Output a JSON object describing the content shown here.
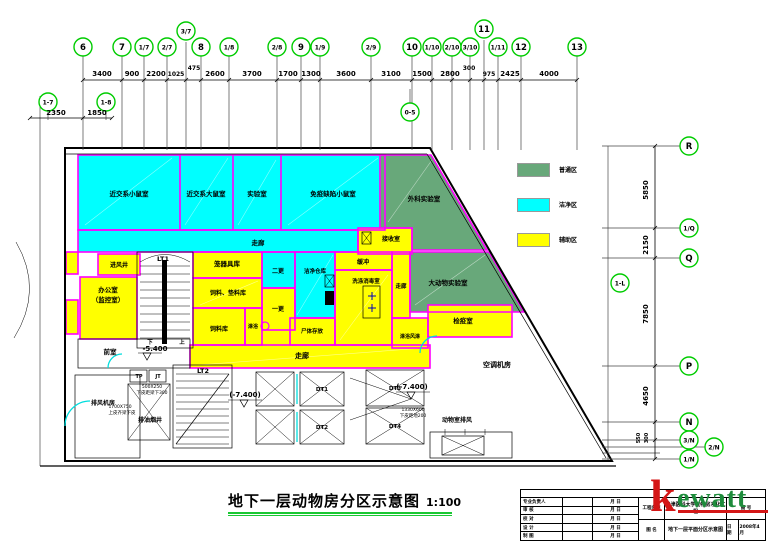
{
  "title": {
    "text": "地下一层动物房分区示意图",
    "scale": "1:100"
  },
  "legend": {
    "items": [
      {
        "label": "普通区",
        "color": "#68A87A"
      },
      {
        "label": "洁净区",
        "color": "#00FFFF"
      },
      {
        "label": "辅助区",
        "color": "#FFFF00"
      }
    ]
  },
  "grid": {
    "top": [
      "6",
      "7",
      "1/7",
      "2/7",
      "3/7",
      "8",
      "1/8",
      "2/8",
      "9",
      "1/9",
      "2/9",
      "10",
      "1/10",
      "2/10",
      "3/10",
      "11",
      "1/11",
      "12",
      "13"
    ],
    "top_dims": [
      "3400",
      "900",
      "2200",
      "1025",
      "475",
      "2600",
      "3700",
      "1700",
      "1300",
      "3600",
      "3100",
      "1500",
      "2800",
      "300",
      "975",
      "2425",
      "4000"
    ],
    "left": [
      "1-7",
      "1-8"
    ],
    "left_dims": [
      "2350",
      "1850"
    ],
    "right": [
      "R",
      "1/Q",
      "Q",
      "P",
      "N",
      "3/N",
      "2/N",
      "1/N"
    ],
    "right_dims": [
      "5850",
      "2150",
      "7850",
      "4650",
      "550",
      "300"
    ],
    "extra": [
      "0-5",
      "1-L"
    ]
  },
  "rooms": {
    "mouse_inbred": "近交系小鼠室",
    "rat_inbred": "近交系大鼠室",
    "lab": "实验室",
    "immuno_mouse": "免疫缺陷小鼠室",
    "surgery": "外科实验室",
    "big_animal": "大动物实验室",
    "corridor": "走廊",
    "receive": "接收室",
    "buffer": "缓冲",
    "wash": "洗涤消毒室",
    "clean_store": "洁净仓库",
    "corpse": "尸体存放",
    "quarantine": "检疫室",
    "shower_air": "淋浴风淋",
    "change2": "二更",
    "change1": "一更",
    "shower": "淋浴",
    "cage_store": "笼器具库",
    "bedding_store": "饲料、垫料库",
    "feed_store": "饲料库",
    "office_l1": "办公室",
    "office_l2": "（监控室）",
    "air_inlet": "进风井",
    "ante": "前室",
    "exhaust_room": "排风机房",
    "oil_shaft": "排油烟井",
    "ac_room": "空调机房",
    "animal_exhaust": "动物室排风",
    "lt1": "LT1",
    "lt2": "LT2",
    "dt1": "DT1",
    "dt2": "DT2",
    "dt3": "DT3",
    "dt4": "DT4",
    "tp": "TP",
    "jt": "JT"
  },
  "stairs": {
    "down": "下",
    "up": "上"
  },
  "elevations": {
    "lobby": "-5.400",
    "pit1": "(-7.400)",
    "pit2": "(-7.400)"
  },
  "annotations": {
    "a1a": "500X250",
    "a1b": "下皮距梁下300",
    "a2a": "1700X750",
    "a2b": "上皮齐梁下皮",
    "a3a": "1330X600",
    "a3b": "下皮距地200"
  },
  "titleblock": {
    "logo_k": "k",
    "logo_rest": "ewatt",
    "rows": [
      {
        "label": "专业负责人",
        "md": "月  日"
      },
      {
        "label": "审  核",
        "md": "月  日"
      },
      {
        "label": "校  对",
        "md": "月  日"
      },
      {
        "label": "设  计",
        "md": "月  日"
      },
      {
        "label": "制  图",
        "md": "月  日"
      }
    ],
    "project_label": "工程名称",
    "project_name": "天津医科大学动物房净化工程",
    "drawing_label": "图  名",
    "drawing_name": "地下一层平面分区示意图",
    "no_label": "图  号",
    "date_label": "日  期",
    "date": "2008年4月"
  }
}
